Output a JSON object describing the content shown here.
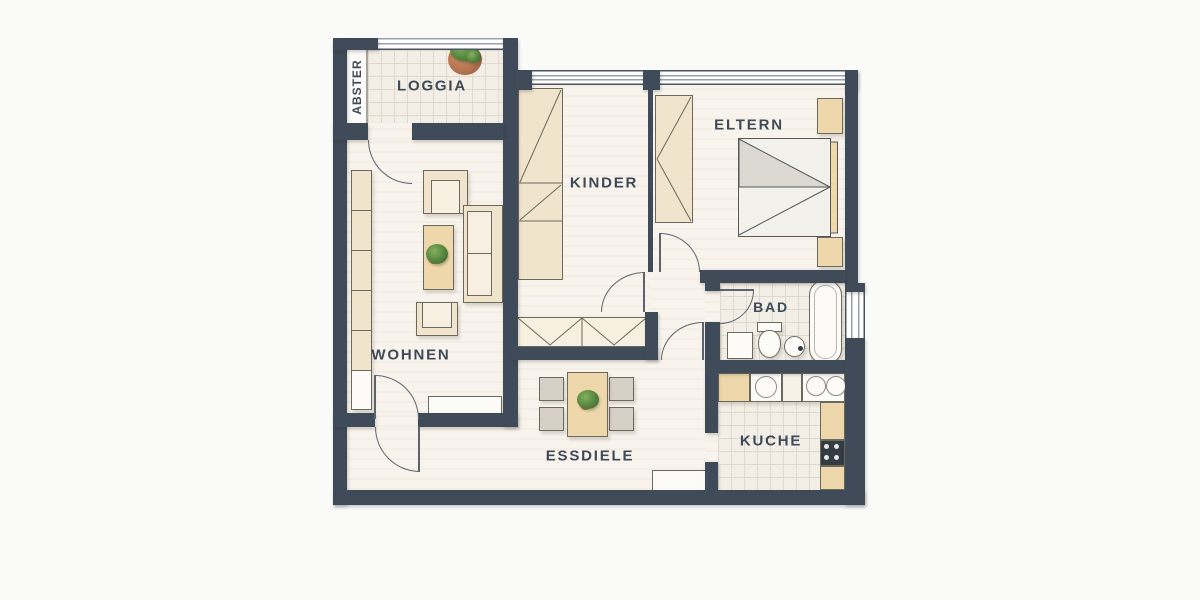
{
  "title": "Apartment floor plan",
  "rooms": {
    "abstellraum": {
      "label": "ABSTER"
    },
    "loggia": {
      "label": "LOGGIA",
      "furniture": [
        "potted-plant"
      ]
    },
    "wohnen": {
      "label": "WOHNEN",
      "furniture": [
        "shelf-unit",
        "armchair",
        "armchair",
        "coffee-table",
        "potted-plant",
        "sofa",
        "sideboard"
      ]
    },
    "kinder": {
      "label": "KINDER",
      "furniture": [
        "wardrobe",
        "bed"
      ]
    },
    "eltern": {
      "label": "ELTERN",
      "furniture": [
        "wardrobe",
        "double-bed",
        "nightstand",
        "nightstand"
      ]
    },
    "bad": {
      "label": "BAD",
      "furniture": [
        "cabinet",
        "toilet",
        "sink",
        "bathtub"
      ]
    },
    "kueche": {
      "label": "KUCHE",
      "furniture": [
        "counter",
        "kitchen-sink",
        "hob",
        "stove",
        "cabinets"
      ]
    },
    "essdiele": {
      "label": "ESSDIELE",
      "furniture": [
        "dining-table",
        "chair",
        "chair",
        "chair",
        "chair",
        "potted-plant",
        "sideboard"
      ]
    }
  },
  "openings": {
    "doors": 6,
    "windows": 3,
    "loggia_railing": 1
  },
  "colors": {
    "bg": "#fafaf8",
    "wall": "#3f4b58",
    "floor": "#f8f3ec",
    "tile": "#f3efe7",
    "tileline": "#ded9cf",
    "beige": "#f1e4cd",
    "beigelight": "#f7efdf",
    "tan": "#eed7ab",
    "graybox": "#d6d0c6",
    "whitebox": "#fcfbf8",
    "text": "#3e4a57",
    "outline": "#6a6a5e",
    "door": "#5b646e",
    "green": "#4f7d3a",
    "pot": "#b3714e",
    "stove": "#333b44",
    "winline": "#4b555f",
    "winline2": "#9aa1a8"
  }
}
